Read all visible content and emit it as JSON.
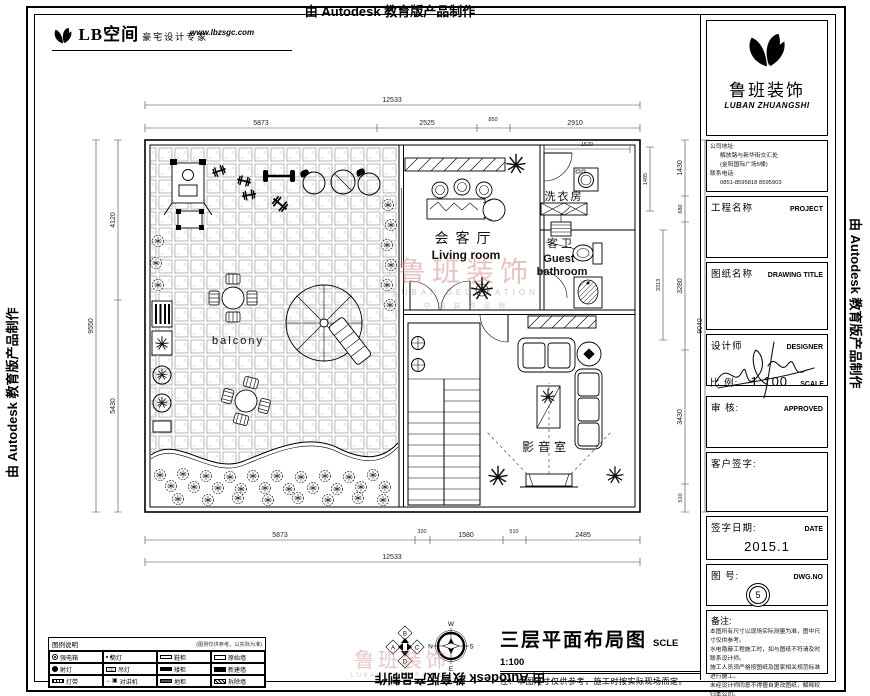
{
  "page": {
    "top_banner": "由 Autodesk 教育版产品制作",
    "left_banner": "由 Autodesk 教育版产品制作",
    "right_banner": "由 Autodesk 教育版产品制作",
    "bottom_banner": "由 Autodesk 教育版产品制作"
  },
  "header_logo": {
    "name": "LB空间",
    "tagline": "豪宅设计专家",
    "url": "www.lbzsgc.com"
  },
  "title_block": {
    "company_cn": "鲁班装饰",
    "company_en": "LUBAN ZHUANGSHI",
    "address_label": "公司地址:",
    "address_line1": "解放路与新华街交汇处",
    "address_line2": "(金阳国际广场5楼)",
    "phone_label": "联系电话:",
    "phone_numbers": "0851-8595818  8595903",
    "project_label": "工程名称",
    "project_en": "PROJECT",
    "drawing_label": "图纸名称",
    "drawing_en": "DRAWING TITLE",
    "designer_label": "设计师",
    "designer_en": "DESIGNER",
    "scale_label": "比 例:",
    "scale_value": "1:100",
    "scale_en": "SCALE",
    "approved_label": "审 核:",
    "approved_en": "APPROVED",
    "client_label": "客户签字:",
    "date_label": "签字日期:",
    "date_en": "DATE",
    "date_value": "2015.1",
    "dwg_label": "图 号:",
    "dwg_en": "DWG.NO",
    "dwg_value": "5",
    "notes_label": "备注:",
    "notes": [
      "本图所有尺寸以现场实际测量为准，图中尺寸仅供参考。",
      "水电隐蔽工程施工时，如与图纸不符请及时联系设计师。",
      "施工人员须严格按图纸及国家相关规范标准进行施工。",
      "未经设计师同意不得擅自更改图纸，解释权归本公司。"
    ]
  },
  "plan": {
    "rooms": {
      "living_cn": "会客厅",
      "living_en": "Living room",
      "laundry": "洗衣房",
      "guest_wc": "客卫",
      "guest_en1": "Guest",
      "guest_en2": "bathroom",
      "balcony": "balcony",
      "media": "影音室"
    },
    "watermark": {
      "cn": "鲁班装饰",
      "en": "LUBAN  DECORATION",
      "sub": "中 国 装 饰 品 牌"
    },
    "dims": {
      "top_total": "12533",
      "top_segs": [
        "5873",
        "2525",
        "850",
        "2910"
      ],
      "bottom_segs": [
        "5873",
        "320",
        "1580",
        "510",
        "2485"
      ],
      "bottom_total": "12533",
      "left_segs": [
        "4120",
        "5430"
      ],
      "left_total": "9550",
      "right_segs": [
        "1430",
        "680",
        "3280",
        "3430",
        "510"
      ],
      "right_total": "9040",
      "laundry_width": "1520",
      "laundry_height": "1485",
      "bath_height": "3313"
    }
  },
  "footer": {
    "title": "三层平面布局图",
    "scale": "SCLE 1:100",
    "note": "注：本图尺寸仅供参考，施工时按实际现场而定。",
    "compass": {
      "top": "W",
      "left": "N",
      "right": "S",
      "bottom": "E"
    },
    "markers": {
      "top": "B",
      "left": "A",
      "right": "C",
      "bottom": "D"
    }
  },
  "legend": {
    "title": "图例说明",
    "hint": "(图例仅供参考，以实际为准)",
    "items": [
      {
        "sym": "circle-dot",
        "label": "强电箱"
      },
      {
        "sym": "double-dot",
        "label": "筒灯"
      },
      {
        "sym": "bar-open",
        "label": "鞋柜"
      },
      {
        "sym": "wall-open",
        "label": "原始墙"
      },
      {
        "sym": "circle-fill",
        "label": "射灯"
      },
      {
        "sym": "cd-box",
        "label": "吊灯"
      },
      {
        "sym": "bar-fill",
        "label": "矮柜"
      },
      {
        "sym": "wall-fill",
        "label": "新建墙"
      },
      {
        "sym": "bar-stripe",
        "label": "灯带"
      },
      {
        "sym": "arrow-box",
        "label": "对讲机"
      },
      {
        "sym": "bar-dark",
        "label": "地柜"
      },
      {
        "sym": "wall-hatch",
        "label": "拆除墙"
      }
    ]
  }
}
